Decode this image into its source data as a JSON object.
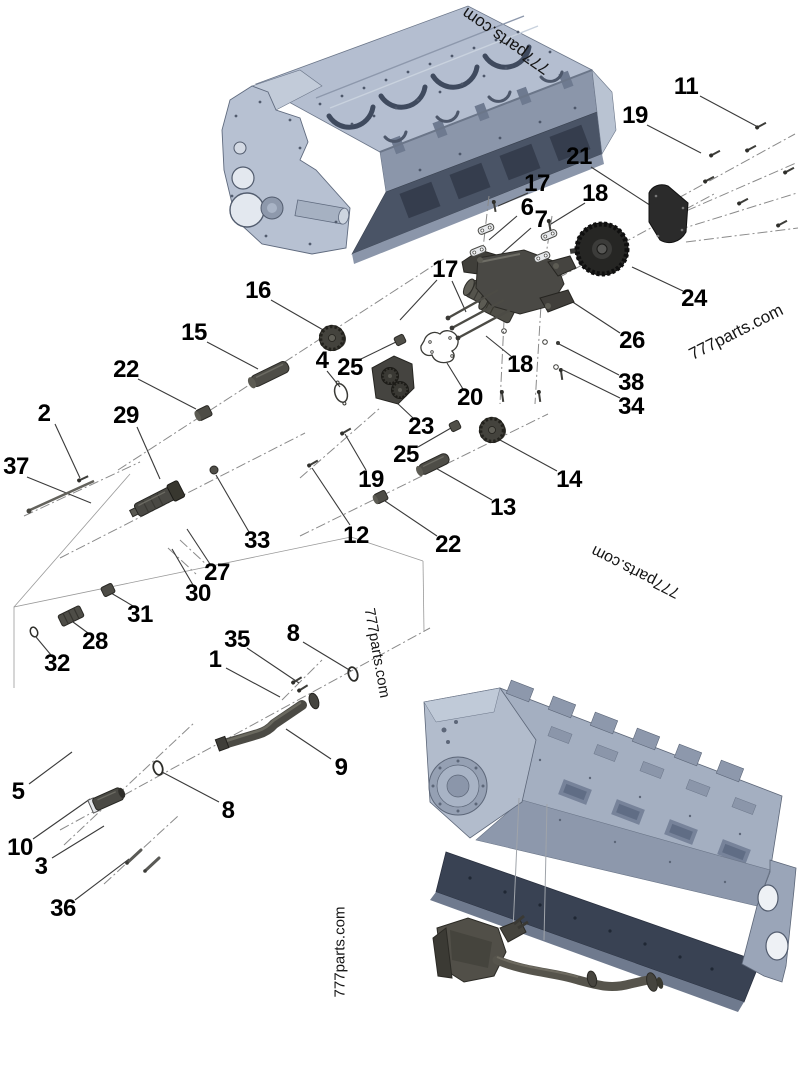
{
  "diagram": {
    "type": "exploded-parts-diagram",
    "subject": "engine block and oil pump assembly",
    "brand_watermark": "777parts.com"
  },
  "colors": {
    "background": "#ffffff",
    "block_light": "#b4bed0",
    "block_mid": "#8b96aa",
    "block_dark": "#4a5466",
    "block_rail": "#394253",
    "part_dark": "#4a4945",
    "part_darker": "#2b2b28",
    "cover_plate": "#2b2b2b",
    "line": "#3a3a3a",
    "label": "#000000"
  },
  "watermarks": [
    {
      "text": "777parts.com"
    },
    {
      "text": "777parts.com"
    },
    {
      "text": "777parts.com"
    },
    {
      "text": "777parts.com"
    },
    {
      "text": "777parts.com"
    }
  ],
  "callouts": [
    {
      "part": "1",
      "text": "1"
    },
    {
      "part": "2",
      "text": "2"
    },
    {
      "part": "3",
      "text": "3"
    },
    {
      "part": "4",
      "text": "4"
    },
    {
      "part": "5",
      "text": "5"
    },
    {
      "part": "6",
      "text": "6"
    },
    {
      "part": "7",
      "text": "7"
    },
    {
      "part": "8",
      "text": "8"
    },
    {
      "part": "8",
      "text": "8"
    },
    {
      "part": "9",
      "text": "9"
    },
    {
      "part": "10",
      "text": "10"
    },
    {
      "part": "11",
      "text": "11"
    },
    {
      "part": "12",
      "text": "12"
    },
    {
      "part": "13",
      "text": "13"
    },
    {
      "part": "14",
      "text": "14"
    },
    {
      "part": "15",
      "text": "15"
    },
    {
      "part": "16",
      "text": "16"
    },
    {
      "part": "17",
      "text": "17"
    },
    {
      "part": "17",
      "text": "17"
    },
    {
      "part": "18",
      "text": "18"
    },
    {
      "part": "18",
      "text": "18"
    },
    {
      "part": "19",
      "text": "19"
    },
    {
      "part": "19",
      "text": "19"
    },
    {
      "part": "20",
      "text": "20"
    },
    {
      "part": "21",
      "text": "21"
    },
    {
      "part": "22",
      "text": "22"
    },
    {
      "part": "22",
      "text": "22"
    },
    {
      "part": "23",
      "text": "23"
    },
    {
      "part": "24",
      "text": "24"
    },
    {
      "part": "25",
      "text": "25"
    },
    {
      "part": "25",
      "text": "25"
    },
    {
      "part": "26",
      "text": "26"
    },
    {
      "part": "27",
      "text": "27"
    },
    {
      "part": "28",
      "text": "28"
    },
    {
      "part": "29",
      "text": "29"
    },
    {
      "part": "30",
      "text": "30"
    },
    {
      "part": "31",
      "text": "31"
    },
    {
      "part": "32",
      "text": "32"
    },
    {
      "part": "33",
      "text": "33"
    },
    {
      "part": "34",
      "text": "34"
    },
    {
      "part": "35",
      "text": "35"
    },
    {
      "part": "36",
      "text": "36"
    },
    {
      "part": "37",
      "text": "37"
    },
    {
      "part": "38",
      "text": "38"
    }
  ]
}
